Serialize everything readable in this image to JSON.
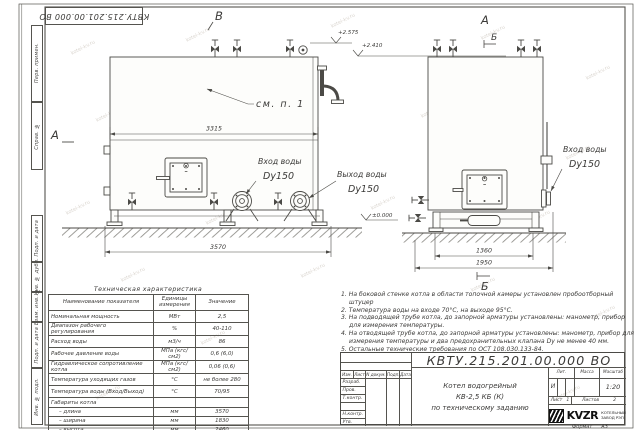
{
  "watermark": "kotel-kv.ru",
  "frame": {
    "doc_number_top": "КВТУ.215.201.00.000 ВО",
    "side_labels": [
      "Перв. примен.",
      "Справ. №",
      "Подп. и дата",
      "Инв. № дубл.",
      "Взам. инв. №",
      "Подп. и дата",
      "Инв. № подл."
    ],
    "format_label": "Формат",
    "format_value": "А3"
  },
  "drawing": {
    "view_b": "В",
    "view_a_front": "А",
    "view_a_side": "А",
    "section_b_top": "Б",
    "section_b_bottom": "Б",
    "see_note": "см. п. 1",
    "dim_3315": "3315",
    "dim_3570": "3570",
    "dim_1360": "1360",
    "dim_1950": "1950",
    "elev_top": "+2.575",
    "elev_mid": "+2.410",
    "elev_zero": "±0.000",
    "front_inlet_line1": "Вход воды",
    "front_inlet_line2": "Dy150",
    "front_outlet_line1": "Выход воды",
    "front_outlet_line2": "Dy150",
    "side_inlet_line1": "Вход воды",
    "side_inlet_line2": "Dy150"
  },
  "spec_table": {
    "title": "Техническая характеристика",
    "headers": [
      "Наименование показателя",
      "Единицы измерения",
      "Значение"
    ],
    "rows": [
      [
        "Номинальная мощность",
        "МВт",
        "2,5"
      ],
      [
        "Диапазон рабочего регулирования",
        "%",
        "40-110"
      ],
      [
        "Расход воды",
        "м3/ч",
        "86"
      ],
      [
        "Рабочее давление воды",
        "МПа (кгс/см2)",
        "0,6 (6,0)"
      ],
      [
        "Гидравлическое сопротивление котла",
        "МПа (кгс/см2)",
        "0,06 (0,6)"
      ],
      [
        "Температура уходящих газов",
        "°С",
        "не более 280"
      ],
      [
        "Температура воды (Вход/Выход)",
        "°С",
        "70/95"
      ],
      [
        "Габариты котла",
        "",
        ""
      ],
      [
        "– длина",
        "мм",
        "3570"
      ],
      [
        "– ширина",
        "мм",
        "1830"
      ],
      [
        "– высота",
        "мм",
        "2460"
      ]
    ]
  },
  "notes": {
    "items": [
      "1. На боковой стенке котла в области топочной камеры установлен пробоотборный штуцер",
      "2. Температура воды на входе 70°С, на выходе 95°С.",
      "3. На подводящей трубе котла, до запорной арматуры установлены: манометр, прибор для измерения температуры.",
      "4. На отводящей трубе котла, до запорной арматуры установлены: манометр, прибор для измерения температуры и два предохранительных клапана Dу не менее 40 мм.",
      "5. Остальные технические требования по ОСТ 108.030.133-84."
    ]
  },
  "title_block": {
    "doc_number": "КВТУ.215.201.00.000 ВО",
    "product_line1": "Котел водогрейный",
    "product_line2": "КВ-2,5 КБ (К)",
    "product_line3": "по техническому заданию",
    "rev_headers": [
      "Изм.",
      "Лист",
      "N докум.",
      "Подп.",
      "Дата"
    ],
    "rev_rows": [
      "Разраб.",
      "Пров.",
      "Т.контр.",
      "",
      "Н.контр.",
      "Утв."
    ],
    "lit_label": "Лит.",
    "lit_value": "И",
    "mass_label": "Масса",
    "scale_label": "Масштаб",
    "scale_value": "1:20",
    "sheet_label": "Лист",
    "sheet_value": "1",
    "sheets_label": "Листов",
    "sheets_value": "2",
    "logo_text": "KVZR",
    "logo_sub1": "КОТЕЛЬНЫЙ",
    "logo_sub2": "ЗАВОД РЭП"
  }
}
